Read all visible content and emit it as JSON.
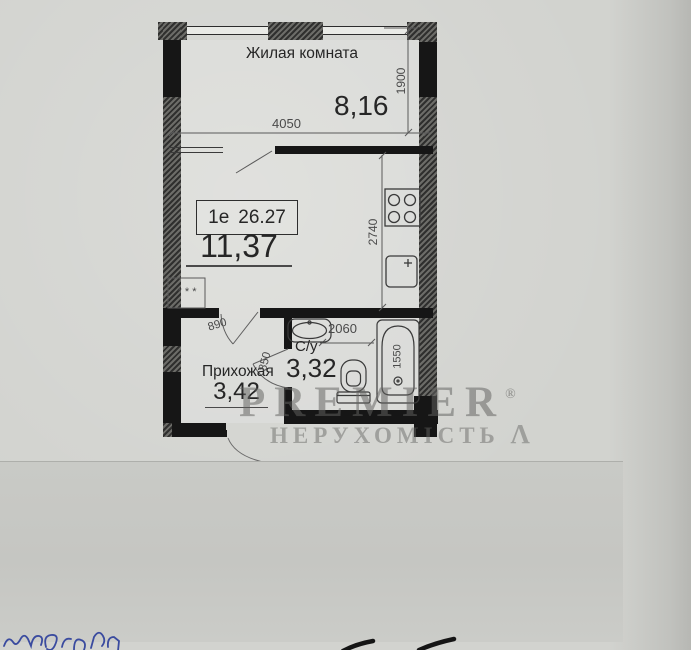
{
  "plan": {
    "apartment": {
      "type_label": "1е",
      "total_area": "26.27"
    },
    "living_room": {
      "name": "Жилая комната",
      "area": "8,16"
    },
    "kitchen_room": {
      "area": "11,37",
      "shaft_marks": "* * *"
    },
    "hallway": {
      "name": "Прихожая",
      "area": "3,42"
    },
    "bathroom": {
      "name": "С/у",
      "area": "3,32"
    },
    "dims": {
      "living_width": "4050",
      "living_depth": "1900",
      "kitchen_depth": "2740",
      "bathroom_width": "2060",
      "bath_length": "1550",
      "door_kitchen": "890",
      "door_bath": "850"
    },
    "fixtures": [
      "stove-icon",
      "kitchen-sink-icon",
      "washbasin-icon",
      "toilet-icon",
      "bathtub-icon"
    ]
  },
  "watermark": {
    "brand": "PREMIER",
    "reg_mark": "®",
    "subtitle": "НЕРУХОМІСТЬ",
    "logo_glyph": "Λ"
  },
  "colors": {
    "paper": "#d2d3cf",
    "wall_black": "#161616",
    "wall_hatch_dark": "#2f2f2e",
    "overlay_gray": "#c7c8c4",
    "watermark_gray": "#626260",
    "ink_blue": "#3a4b9f"
  }
}
